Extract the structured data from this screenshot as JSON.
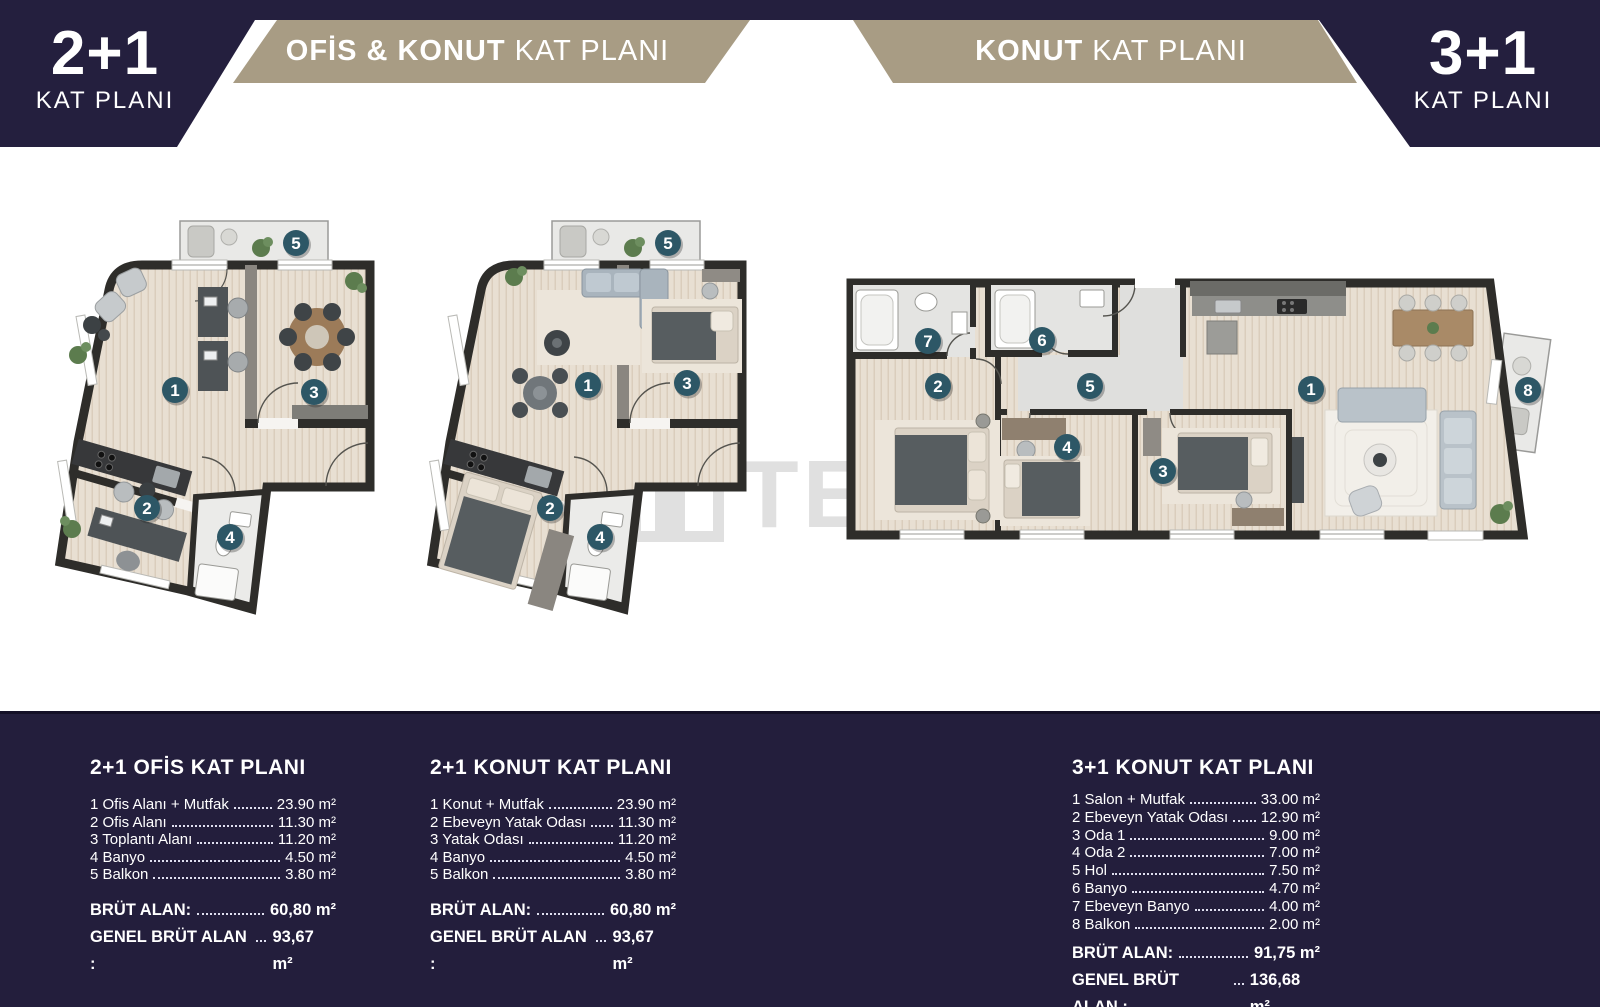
{
  "header": {
    "left_corner": {
      "big": "2+1",
      "small": "KAT PLANI"
    },
    "right_corner": {
      "big": "3+1",
      "small": "KAT PLANI"
    },
    "left_banner": {
      "bold": "OFİS & KONUT",
      "regular": "KAT PLANI"
    },
    "right_banner": {
      "bold": "KONUT",
      "regular": "KAT PLANI"
    }
  },
  "watermark": "TEKCE",
  "colors": {
    "navy": "#241f3e",
    "tan": "#a89c84",
    "badge_teal": "#2d5766",
    "wall": "#2e2d2a",
    "wood_floor": "#e8dfd2",
    "tile_floor": "#e4e4e2"
  },
  "plans": [
    {
      "name": "2+1 ofis kat plani",
      "badges": [
        {
          "n": "1",
          "x": 145,
          "y": 195
        },
        {
          "n": "2",
          "x": 117,
          "y": 313
        },
        {
          "n": "3",
          "x": 284,
          "y": 197
        },
        {
          "n": "4",
          "x": 200,
          "y": 342
        },
        {
          "n": "5",
          "x": 266,
          "y": 48
        }
      ]
    },
    {
      "name": "2+1 konut kat plani",
      "badges": [
        {
          "n": "1",
          "x": 186,
          "y": 190
        },
        {
          "n": "2",
          "x": 148,
          "y": 313
        },
        {
          "n": "3",
          "x": 285,
          "y": 188
        },
        {
          "n": "4",
          "x": 198,
          "y": 342
        },
        {
          "n": "5",
          "x": 266,
          "y": 48
        }
      ]
    },
    {
      "name": "3+1 konut kat plani",
      "badges": [
        {
          "n": "1",
          "x": 471,
          "y": 121
        },
        {
          "n": "2",
          "x": 98,
          "y": 118
        },
        {
          "n": "3",
          "x": 323,
          "y": 203
        },
        {
          "n": "4",
          "x": 227,
          "y": 179
        },
        {
          "n": "5",
          "x": 250,
          "y": 118
        },
        {
          "n": "6",
          "x": 202,
          "y": 72
        },
        {
          "n": "7",
          "x": 88,
          "y": 73
        },
        {
          "n": "8",
          "x": 688,
          "y": 122
        }
      ]
    }
  ],
  "legend": {
    "columns": [
      {
        "title": "2+1 OFİS KAT PLANI",
        "items": [
          {
            "label": "1 Ofis Alanı + Mutfak",
            "value": "23.90 m²"
          },
          {
            "label": "2 Ofis Alanı",
            "value": "11.30 m²"
          },
          {
            "label": "3 Toplantı Alanı",
            "value": "11.20 m²"
          },
          {
            "label": "4 Banyo",
            "value": "4.50 m²"
          },
          {
            "label": "5 Balkon",
            "value": "3.80 m²"
          }
        ],
        "totals": [
          {
            "label": "BRÜT ALAN:",
            "value": "60,80 m²"
          },
          {
            "label": "GENEL BRÜT ALAN :",
            "value": "93,67 m²"
          }
        ]
      },
      {
        "title": "2+1 KONUT KAT PLANI",
        "items": [
          {
            "label": "1 Konut + Mutfak",
            "value": "23.90 m²"
          },
          {
            "label": "2 Ebeveyn Yatak Odası",
            "value": "11.30 m²"
          },
          {
            "label": "3 Yatak Odası",
            "value": "11.20 m²"
          },
          {
            "label": "4 Banyo",
            "value": "4.50 m²"
          },
          {
            "label": "5 Balkon",
            "value": "3.80 m²"
          }
        ],
        "totals": [
          {
            "label": "BRÜT ALAN:",
            "value": "60,80 m²"
          },
          {
            "label": "GENEL BRÜT ALAN :",
            "value": "93,67 m²"
          }
        ]
      },
      {
        "title": "3+1 KONUT KAT PLANI",
        "items": [
          {
            "label": "1 Salon + Mutfak",
            "value": "33.00 m²"
          },
          {
            "label": "2 Ebeveyn Yatak Odası",
            "value": "12.90 m²"
          },
          {
            "label": "3 Oda 1",
            "value": "9.00 m²"
          },
          {
            "label": "4 Oda 2",
            "value": "7.00 m²"
          },
          {
            "label": "5 Hol",
            "value": "7.50 m²"
          },
          {
            "label": "6 Banyo",
            "value": "4.70 m²"
          },
          {
            "label": "7 Ebeveyn Banyo",
            "value": "4.00 m²"
          },
          {
            "label": "8 Balkon",
            "value": "2.00 m²"
          }
        ],
        "totals": [
          {
            "label": "BRÜT ALAN:",
            "value": "91,75 m²"
          },
          {
            "label": "GENEL BRÜT ALAN : ",
            "value": "136,68 m²"
          }
        ]
      }
    ]
  }
}
